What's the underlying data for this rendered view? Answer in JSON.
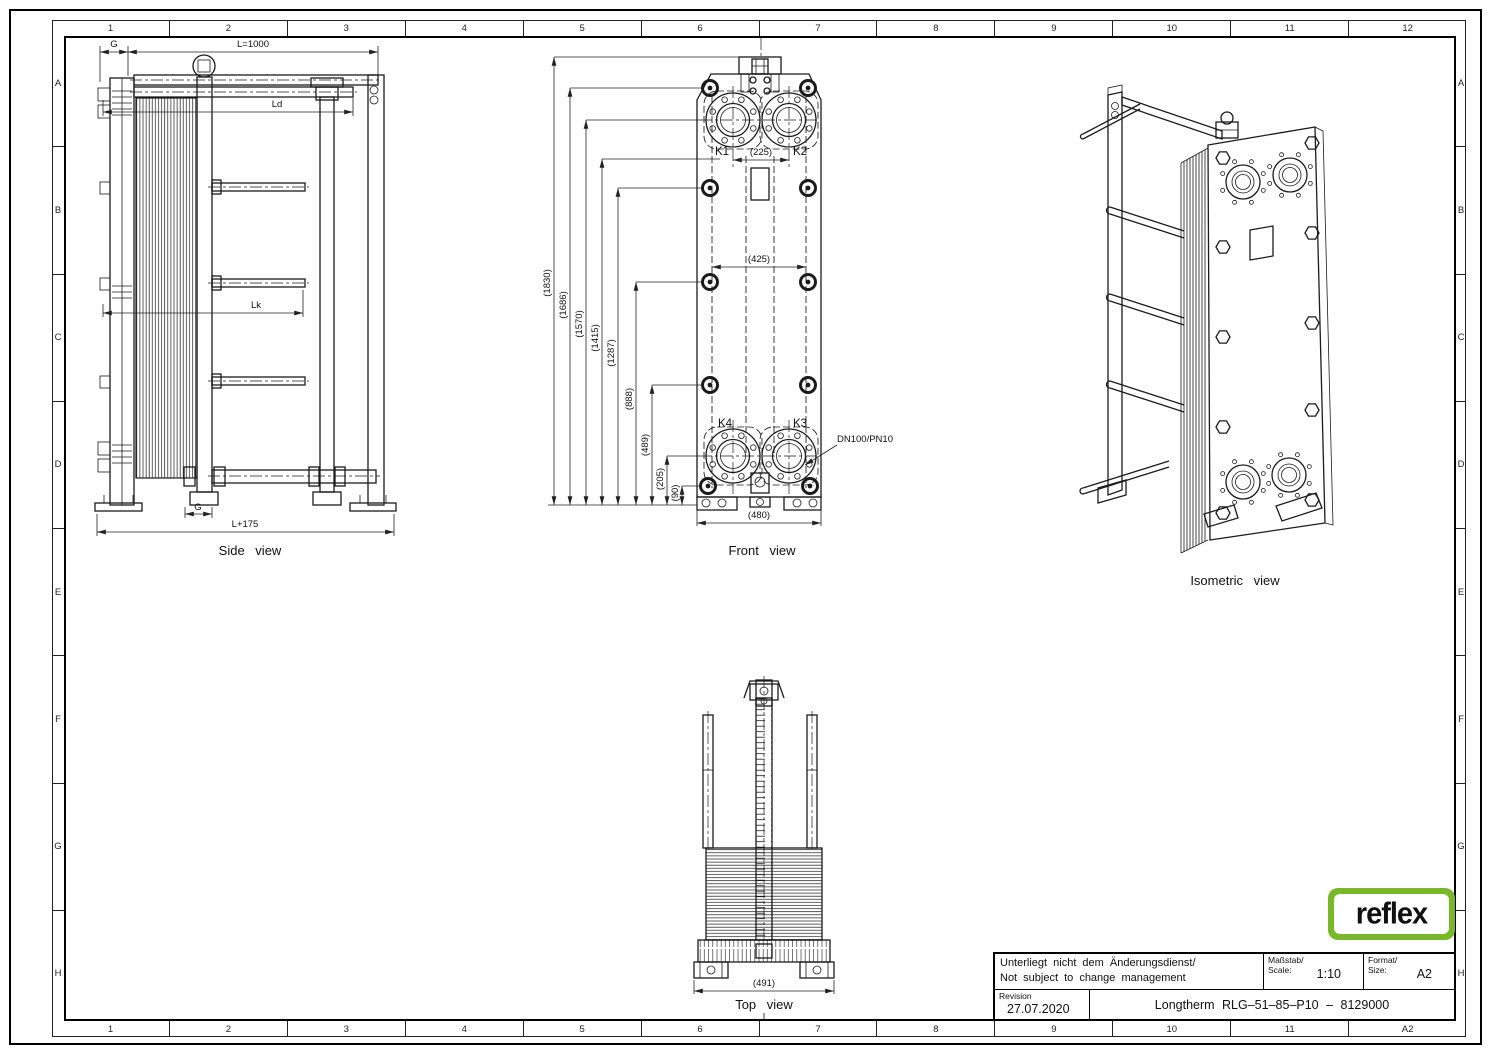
{
  "border": {
    "columns": [
      "1",
      "2",
      "3",
      "4",
      "5",
      "6",
      "7",
      "8",
      "9",
      "10",
      "11",
      "12"
    ],
    "rows": [
      "A",
      "B",
      "C",
      "D",
      "E",
      "F",
      "G",
      "H"
    ],
    "bottom_right": "A2"
  },
  "views": {
    "side": {
      "caption": "Side view",
      "dim_g_top": "G",
      "dim_length": "L=1000",
      "dim_ld": "Ld",
      "dim_lk": "Lk",
      "dim_g_bottom": "G",
      "dim_overall": "L+175"
    },
    "front": {
      "caption": "Front view",
      "dim_heights": [
        "(1830)",
        "(1686)",
        "(1570)",
        "(1415)",
        "(1287)",
        "(888)",
        "(489)",
        "(205)",
        "(90)"
      ],
      "port_k1": "K1",
      "port_k2": "K2",
      "port_k3": "K3",
      "port_k4": "K4",
      "dim_port_spacing": "(225)",
      "dim_bolt_spacing": "(425)",
      "dim_width": "(480)",
      "connection_label": "DN100/PN10"
    },
    "top": {
      "caption": "Top view",
      "dim_width": "(491)"
    },
    "isometric": {
      "caption": "Isometric view"
    }
  },
  "title_block": {
    "note_de": "Unterliegt nicht dem Änderungsdienst/",
    "note_en": "Not subject to change management",
    "scale_label_de": "Maßstab/",
    "scale_label_en": "Scale:",
    "scale_value": "1:10",
    "format_label_de": "Format/",
    "format_label_en": "Size:",
    "format_value": "A2",
    "revision_label": "Revision",
    "revision_date": "27.07.2020",
    "title": "Longtherm RLG–51–85–P10 – 8129000"
  },
  "logo": {
    "brand": "reflex",
    "green": "#79b829"
  }
}
